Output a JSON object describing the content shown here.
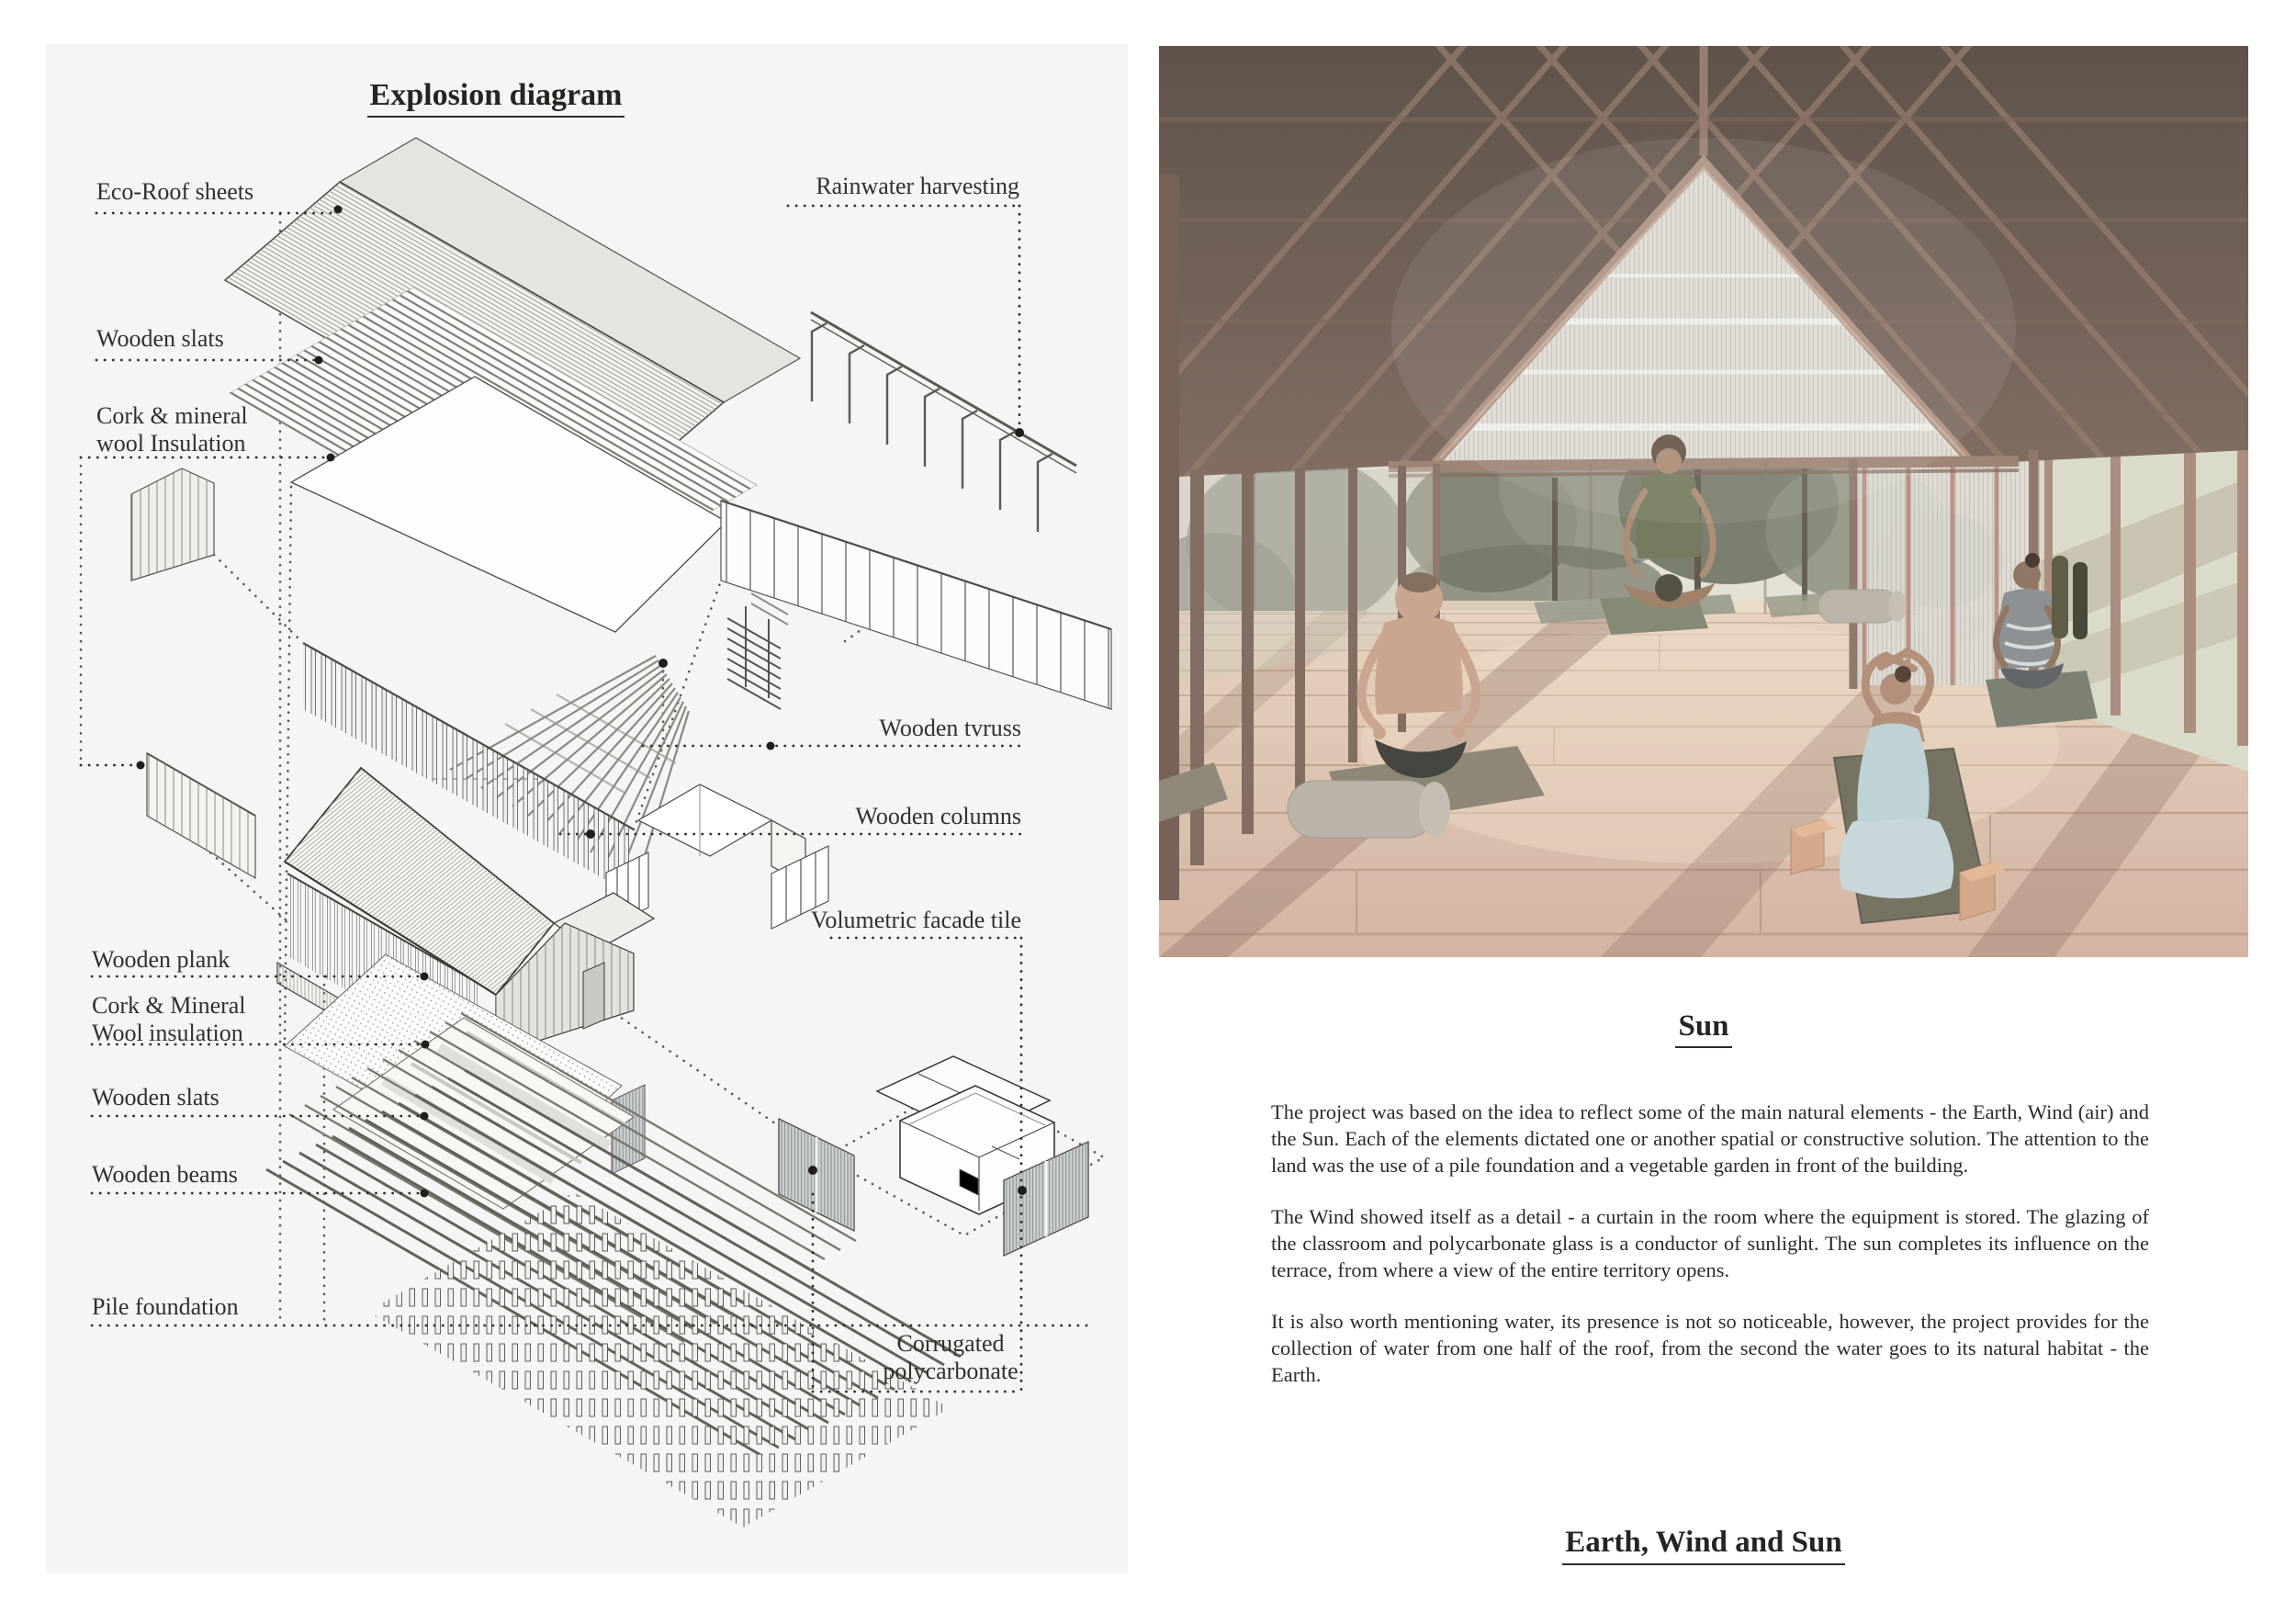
{
  "left_panel": {
    "title": "Explosion diagram",
    "labels": {
      "eco_roof": "Eco-Roof sheets",
      "wooden_slats_top": "Wooden slats",
      "cork_top_l1": "Cork & mineral",
      "cork_top_l2": "wool Insulation",
      "rainwater": "Rainwater harvesting",
      "truss": "Wooden tvruss",
      "columns": "Wooden columns",
      "facade_tile": "Volumetric facade tile",
      "plank": "Wooden plank",
      "cork_bottom_l1": "Cork & Mineral",
      "cork_bottom_l2": "Wool insulation",
      "wooden_slats_bottom": "Wooden slats",
      "beams": "Wooden beams",
      "pile": "Pile foundation",
      "corrugated_l1": "Corrugated",
      "corrugated_l2": "polycarbonate"
    }
  },
  "right_panel": {
    "photo_caption": "Sun",
    "paragraphs": {
      "p1": "The project was based on the idea to reflect some of the main natural elements - the Earth, Wind (air) and the Sun. Each of the elements dictated one or another spatial or constructive solution. The attention to the land was the use of a pile foundation and a vegetable garden in front of the building.",
      "p2": "The Wind showed itself as a detail - a curtain in the room where the equipment is stored. The glazing of the classroom and polycarbonate glass is a conductor of sunlight. The sun completes its influence on the terrace, from where a view of the entire territory opens.",
      "p3": "It is also worth mentioning water, its presence is not so noticeable, however, the project provides for the collection of water from one half of the roof, from the second the water goes to its natural habitat - the Earth."
    },
    "footer_title": "Earth, Wind and Sun"
  },
  "colors": {
    "panel_bg": "#f6f5f3",
    "ink": "#2f2e2b",
    "ceiling_wood": "#6a5b53",
    "floor_wood": "#dcc0ae",
    "accent_beam": "#a38778"
  }
}
